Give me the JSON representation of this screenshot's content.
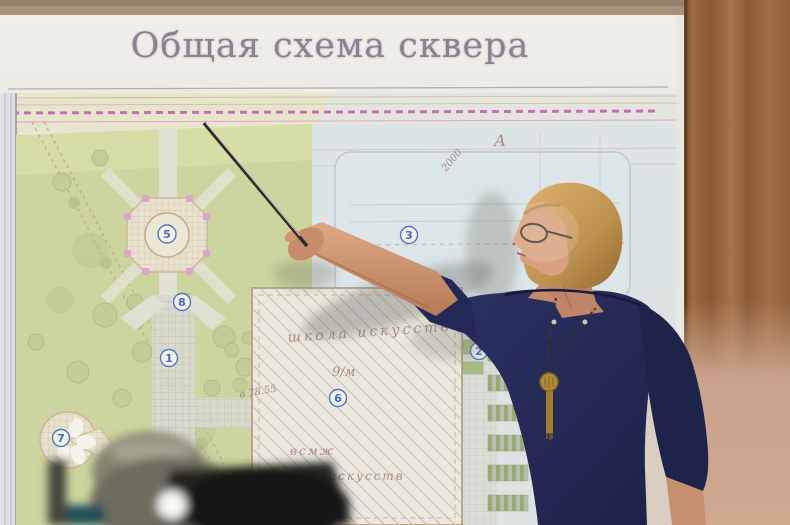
{
  "slide": {
    "title": "Общая схема сквера"
  },
  "map": {
    "labels": {
      "building_name_top": "школа искусств",
      "building_sign": "9/м",
      "building_abbr": "всмж",
      "building_name_bottom": "школа искусств",
      "elevation_mark": "в 78.55",
      "dimension": "2000",
      "section_letter": "А"
    },
    "markers": {
      "m1": "1",
      "m2": "2",
      "m3": "3",
      "m5": "5",
      "m6": "6",
      "m7": "7",
      "m8": "8"
    }
  },
  "colors": {
    "park_green": "#ccd59f",
    "slide_bg": "#e9e8e4",
    "accent_magenta": "#c76fb4",
    "dress_navy": "#272c58",
    "wall_wood": "#9c6b42",
    "wall_pink": "#c9a38c"
  }
}
